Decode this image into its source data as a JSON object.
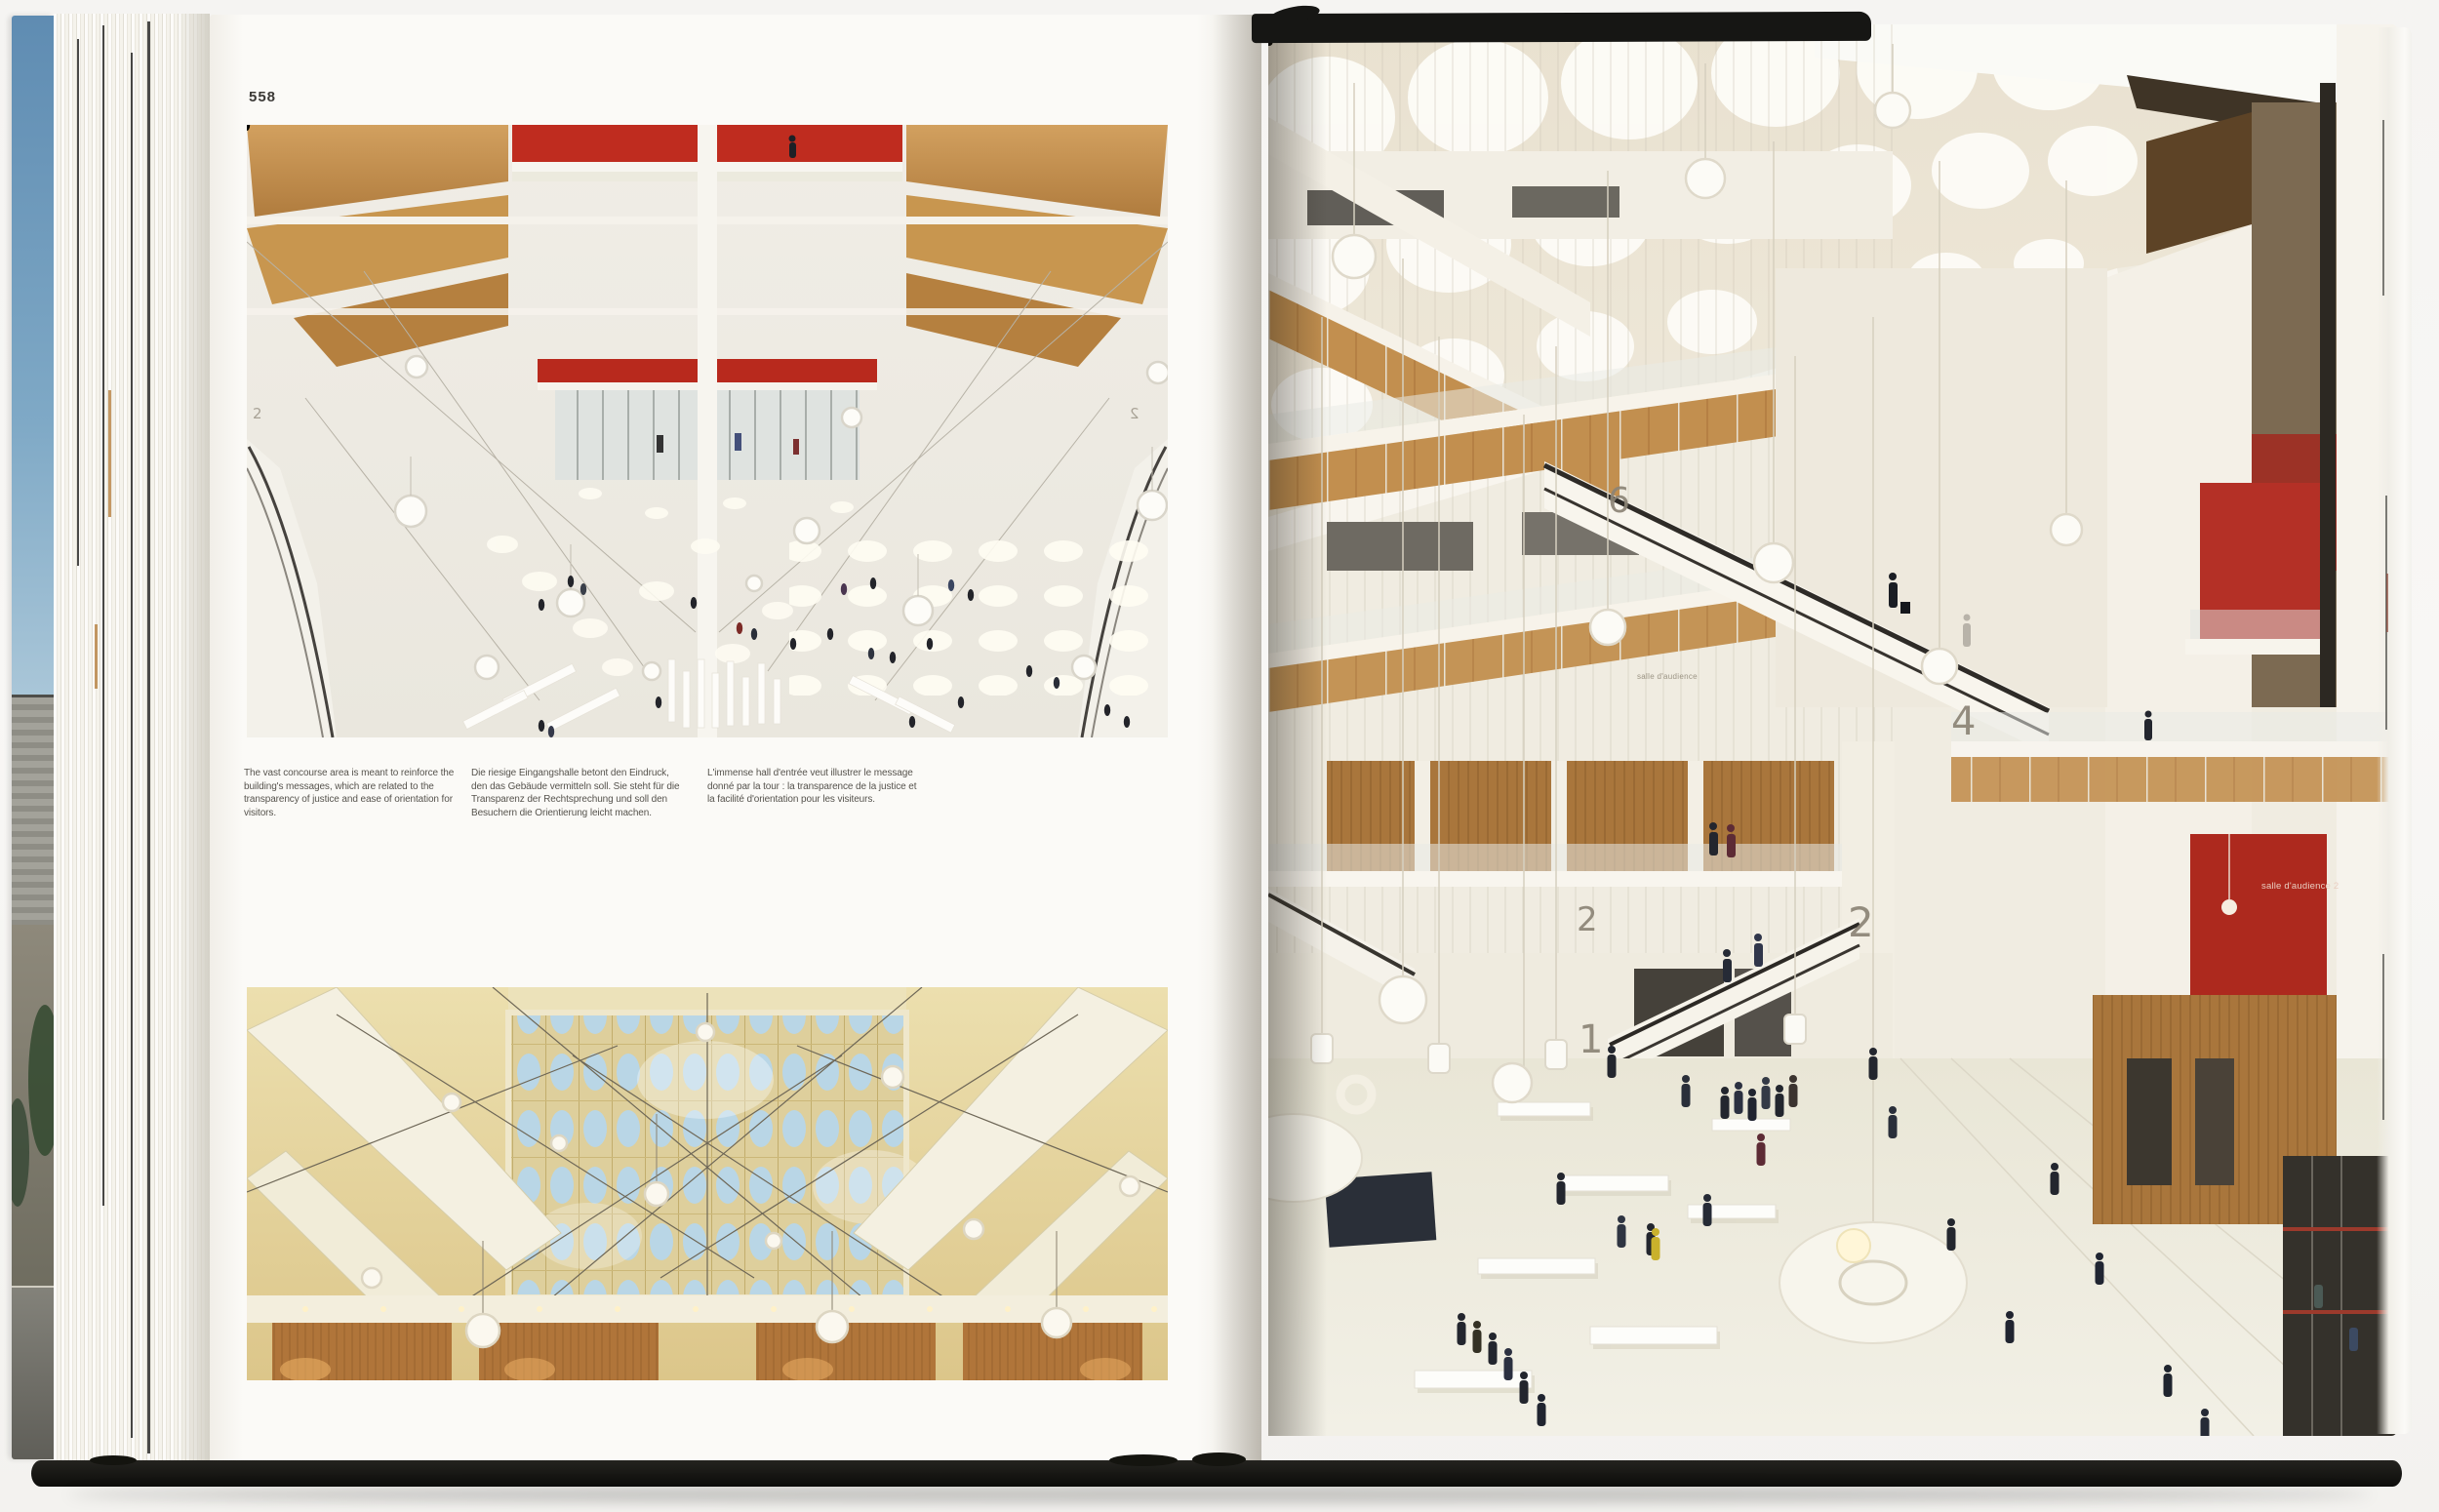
{
  "book": {
    "left_page": {
      "page_number": "558",
      "captions": {
        "en": "The vast concourse area is meant to reinforce the building's messages, which are related to the transparency of justice and ease of orientation for visitors.",
        "de": "Die riesige Eingangshalle betont den Eindruck, den das Gebäude vermitteln soll. Sie steht für die Transparenz der Rechtsprechung und soll den Besuchern die Orientierung leicht machen.",
        "fr": "L'immense hall d'entrée veut illustrer le message donné par la tour : la transparence de la justice et la facilité d'orientation pour les visiteurs."
      },
      "photo_top_levels": {
        "left": "2",
        "right": "2"
      }
    },
    "right_page": {
      "floor_labels": {
        "six": "6",
        "four": "4",
        "two_left": "2",
        "two_right": "2",
        "one": "1"
      },
      "signs": {
        "red_panel": "salle d'audience 2",
        "wall_left": "salle d'audience"
      }
    },
    "colors": {
      "accent_red": "#b5271d",
      "wood": "#c08c4f",
      "skylight_blue": "#bcd9e8",
      "cover_black": "#161614",
      "page_white": "#fbfaf7"
    }
  }
}
